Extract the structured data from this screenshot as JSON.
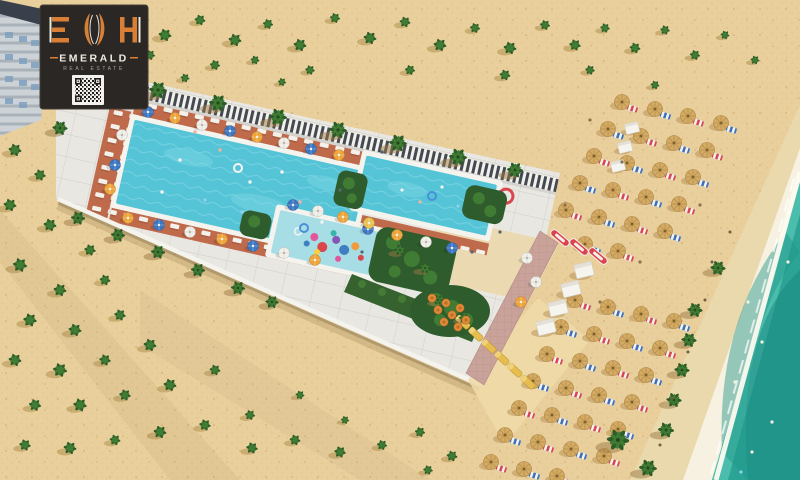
{
  "logo": {
    "monogram": "EMH",
    "monogram_left": "E",
    "monogram_right": "H",
    "brand": "EMERALD",
    "subtitle": "REAL ESTATE",
    "qr_icon": "qr-code",
    "colors": {
      "card": "#2b2724",
      "accent": "#d87f35",
      "text": "#f0ebe1",
      "subtext": "#aaa49a"
    }
  },
  "scene": {
    "type": "aerial-3d-render",
    "description": "Aerial 3D rendering of a beachfront resort strip with a large swimming pool, family pool, kids aqua-park pool with water slide, sun loungers and umbrellas, palm groves on sand, straw beach umbrellas, white cabanas, kayaks, and a turquoise sea shoreline",
    "features": [
      "apartment-building",
      "main-pool",
      "family-pool",
      "kids-pool",
      "water-slide",
      "perimeter-fence",
      "sun-deck",
      "restaurant-terrace",
      "garden-beds",
      "paved-path",
      "beach-umbrellas",
      "cabanas",
      "kayaks",
      "palm-trees",
      "sea-shoreline"
    ],
    "colors": {
      "sand": "#e9cf9c",
      "sand_speckle": "#d7b67e",
      "wet_sand": "#ead9ad",
      "foam": "#f6f1e0",
      "sea": "#2ba495",
      "sea_dark": "#17867d",
      "sea_light": "#52c3b2",
      "deck": "#e9e7e2",
      "pool_water": "#55c4d6",
      "kids_water": "#a7dde4",
      "mat": "#bf6a4b",
      "hedge": "#2f5c2c",
      "fence_dark": "#454a52",
      "umbrella_blue": "#3d77c2",
      "umbrella_orange": "#eda43b",
      "umbrella_white": "#f2f0ea",
      "straw": "#d4ab64",
      "kayak_red": "#db4350",
      "lounger_yellow": "#e6bd4e",
      "path_pink": "#c9a39a"
    },
    "sprite_names": {
      "buR": "beach-umbrella-with-lounger",
      "buB": "beach-umbrella-with-lounger",
      "cab": "beach-cabana",
      "kayak": "kayak",
      "ylg": "yellow-lounger",
      "palm": "palm-tree",
      "shrub": "desert-shrub",
      "umbB": "pool-umbrella",
      "umbO": "pool-umbrella",
      "umbW": "pool-umbrella",
      "umbY": "pool-umbrella",
      "tbl": "dining-table",
      "ringW": "swim-ring",
      "ringB": "swim-ring",
      "dot": "person"
    },
    "sprites": [
      [
        "buR",
        622,
        102
      ],
      [
        "buB",
        655,
        109
      ],
      [
        "buR",
        688,
        116
      ],
      [
        "buB",
        721,
        123
      ],
      [
        "buB",
        608,
        129
      ],
      [
        "buR",
        641,
        136
      ],
      [
        "buB",
        674,
        143
      ],
      [
        "buR",
        707,
        150
      ],
      [
        "buR",
        594,
        156
      ],
      [
        "buB",
        627,
        163
      ],
      [
        "buR",
        660,
        170
      ],
      [
        "buB",
        693,
        177
      ],
      [
        "buB",
        580,
        183
      ],
      [
        "buR",
        613,
        190
      ],
      [
        "buB",
        646,
        197
      ],
      [
        "buR",
        679,
        204
      ],
      [
        "buR",
        566,
        210
      ],
      [
        "buB",
        599,
        217
      ],
      [
        "buR",
        632,
        224
      ],
      [
        "buB",
        665,
        231
      ],
      [
        "buB",
        585,
        244
      ],
      [
        "buR",
        618,
        251
      ],
      [
        "buR",
        575,
        300
      ],
      [
        "buB",
        608,
        307
      ],
      [
        "buR",
        641,
        314
      ],
      [
        "buB",
        674,
        321
      ],
      [
        "buB",
        561,
        327
      ],
      [
        "buR",
        594,
        334
      ],
      [
        "buB",
        627,
        341
      ],
      [
        "buR",
        660,
        348
      ],
      [
        "buR",
        547,
        354
      ],
      [
        "buB",
        580,
        361
      ],
      [
        "buR",
        613,
        368
      ],
      [
        "buB",
        646,
        375
      ],
      [
        "buB",
        533,
        381
      ],
      [
        "buR",
        566,
        388
      ],
      [
        "buB",
        599,
        395
      ],
      [
        "buR",
        632,
        402
      ],
      [
        "buR",
        519,
        408
      ],
      [
        "buB",
        552,
        415
      ],
      [
        "buR",
        585,
        422
      ],
      [
        "buB",
        618,
        429
      ],
      [
        "buB",
        505,
        435
      ],
      [
        "buR",
        538,
        442
      ],
      [
        "buB",
        571,
        449
      ],
      [
        "buR",
        604,
        456
      ],
      [
        "buR",
        491,
        462
      ],
      [
        "buB",
        524,
        469
      ],
      [
        "buR",
        557,
        476
      ],
      [
        "cab",
        632,
        128,
        0,
        0.75
      ],
      [
        "cab",
        625,
        147,
        0,
        0.75
      ],
      [
        "cab",
        618,
        166,
        0,
        0.75
      ],
      [
        "cab",
        584,
        270
      ],
      [
        "cab",
        571,
        289
      ],
      [
        "cab",
        558,
        308
      ],
      [
        "cab",
        546,
        327
      ],
      [
        "kayak",
        560,
        238,
        40
      ],
      [
        "kayak",
        579,
        247,
        40
      ],
      [
        "kayak",
        598,
        256,
        40
      ],
      [
        "ylg",
        463,
        322,
        43
      ],
      [
        "ylg",
        476,
        334,
        43
      ],
      [
        "ylg",
        489,
        346,
        43
      ],
      [
        "ylg",
        502,
        358,
        43
      ],
      [
        "ylg",
        515,
        370,
        43
      ],
      [
        "ylg",
        528,
        382,
        43
      ],
      [
        "palm",
        98,
        76
      ],
      [
        "palm",
        158,
        90
      ],
      [
        "palm",
        218,
        103
      ],
      [
        "palm",
        278,
        117
      ],
      [
        "palm",
        338,
        130
      ],
      [
        "palm",
        398,
        143
      ],
      [
        "palm",
        458,
        157
      ],
      [
        "palm",
        515,
        170,
        0,
        0.9
      ],
      [
        "palm",
        60,
        128,
        0,
        0.85
      ],
      [
        "palm",
        78,
        218,
        0,
        0.8
      ],
      [
        "palm",
        118,
        235,
        0,
        0.8
      ],
      [
        "palm",
        158,
        252,
        0,
        0.8
      ],
      [
        "palm",
        198,
        270,
        0,
        0.8
      ],
      [
        "palm",
        238,
        288,
        0,
        0.8
      ],
      [
        "palm",
        272,
        302,
        0,
        0.75
      ],
      [
        "palm",
        695,
        310,
        0,
        0.85
      ],
      [
        "palm",
        689,
        340,
        0,
        0.85
      ],
      [
        "palm",
        682,
        370,
        0,
        0.85
      ],
      [
        "palm",
        674,
        400,
        0,
        0.85
      ],
      [
        "palm",
        666,
        430,
        0,
        0.9
      ],
      [
        "palm",
        618,
        440,
        0,
        1.25
      ],
      [
        "palm",
        648,
        468,
        0,
        1
      ],
      [
        "palm",
        718,
        268,
        0,
        0.85
      ],
      [
        "palm",
        400,
        250,
        0,
        0.65
      ],
      [
        "palm",
        425,
        268,
        0,
        0.65
      ],
      [
        "palm",
        438,
        300,
        0,
        0.6
      ],
      [
        "palm",
        464,
        318,
        0,
        0.6
      ],
      [
        "shrub",
        165,
        35
      ],
      [
        "shrub",
        200,
        20,
        0,
        0.85
      ],
      [
        "shrub",
        235,
        40
      ],
      [
        "shrub",
        268,
        24,
        0,
        0.8
      ],
      [
        "shrub",
        300,
        45
      ],
      [
        "shrub",
        335,
        18,
        0,
        0.8
      ],
      [
        "shrub",
        370,
        38
      ],
      [
        "shrub",
        405,
        22,
        0,
        0.85
      ],
      [
        "shrub",
        440,
        45
      ],
      [
        "shrub",
        475,
        28,
        0,
        0.8
      ],
      [
        "shrub",
        510,
        48
      ],
      [
        "shrub",
        545,
        25,
        0,
        0.8
      ],
      [
        "shrub",
        575,
        45,
        0,
        0.9
      ],
      [
        "shrub",
        605,
        28,
        0,
        0.75
      ],
      [
        "shrub",
        635,
        48,
        0,
        0.85
      ],
      [
        "shrub",
        665,
        30,
        0,
        0.75
      ],
      [
        "shrub",
        695,
        55,
        0,
        0.8
      ],
      [
        "shrub",
        725,
        35,
        0,
        0.7
      ],
      [
        "shrub",
        755,
        60,
        0,
        0.7
      ],
      [
        "shrub",
        215,
        65,
        0,
        0.8
      ],
      [
        "shrub",
        310,
        70,
        0,
        0.75
      ],
      [
        "shrub",
        410,
        70,
        0,
        0.8
      ],
      [
        "shrub",
        505,
        75,
        0,
        0.85
      ],
      [
        "shrub",
        590,
        70,
        0,
        0.75
      ],
      [
        "shrub",
        655,
        85,
        0,
        0.7
      ],
      [
        "shrub",
        150,
        55,
        0,
        0.8
      ],
      [
        "shrub",
        185,
        78,
        0,
        0.7
      ],
      [
        "shrub",
        255,
        60,
        0,
        0.7
      ],
      [
        "shrub",
        282,
        82,
        0,
        0.65
      ],
      [
        "shrub",
        15,
        150
      ],
      [
        "shrub",
        40,
        175,
        0,
        0.9
      ],
      [
        "shrub",
        10,
        205
      ],
      [
        "shrub",
        50,
        225
      ],
      [
        "shrub",
        90,
        250,
        0,
        0.9
      ],
      [
        "shrub",
        20,
        265,
        0,
        1.1
      ],
      [
        "shrub",
        60,
        290
      ],
      [
        "shrub",
        105,
        280,
        0,
        0.85
      ],
      [
        "shrub",
        30,
        320,
        0,
        1.05
      ],
      [
        "shrub",
        75,
        330
      ],
      [
        "shrub",
        120,
        315,
        0,
        0.9
      ],
      [
        "shrub",
        15,
        360
      ],
      [
        "shrub",
        60,
        370,
        0,
        1.1
      ],
      [
        "shrub",
        105,
        360,
        0,
        0.9
      ],
      [
        "shrub",
        150,
        345
      ],
      [
        "shrub",
        35,
        405,
        0,
        0.95
      ],
      [
        "shrub",
        80,
        405,
        0,
        1.05
      ],
      [
        "shrub",
        125,
        395,
        0,
        0.9
      ],
      [
        "shrub",
        170,
        385
      ],
      [
        "shrub",
        215,
        370,
        0,
        0.85
      ],
      [
        "shrub",
        25,
        445,
        0,
        0.9
      ],
      [
        "shrub",
        70,
        448
      ],
      [
        "shrub",
        115,
        440,
        0,
        0.85
      ],
      [
        "shrub",
        160,
        432
      ],
      [
        "shrub",
        205,
        425,
        0,
        0.9
      ],
      [
        "shrub",
        250,
        415,
        0,
        0.8
      ],
      [
        "shrub",
        252,
        448,
        0,
        0.9
      ],
      [
        "shrub",
        295,
        440,
        0,
        0.85
      ],
      [
        "shrub",
        340,
        452,
        0,
        0.9
      ],
      [
        "shrub",
        382,
        445,
        0,
        0.8
      ],
      [
        "shrub",
        300,
        395,
        0,
        0.7
      ],
      [
        "shrub",
        345,
        420,
        0,
        0.65
      ],
      [
        "shrub",
        420,
        432,
        0,
        0.8
      ],
      [
        "shrub",
        452,
        456,
        0,
        0.85
      ],
      [
        "shrub",
        428,
        470,
        0,
        0.75
      ],
      [
        "umbB",
        148,
        112
      ],
      [
        "umbO",
        175,
        118
      ],
      [
        "umbW",
        202,
        125
      ],
      [
        "umbB",
        230,
        131
      ],
      [
        "umbO",
        257,
        137
      ],
      [
        "umbW",
        284,
        143
      ],
      [
        "umbB",
        311,
        149
      ],
      [
        "umbO",
        339,
        155
      ],
      [
        "umbO",
        128,
        218
      ],
      [
        "umbB",
        159,
        225
      ],
      [
        "umbW",
        190,
        232
      ],
      [
        "umbO",
        222,
        239
      ],
      [
        "umbB",
        253,
        246
      ],
      [
        "umbW",
        284,
        253
      ],
      [
        "umbO",
        315,
        260
      ],
      [
        "umbW",
        122,
        135
      ],
      [
        "umbB",
        115,
        165
      ],
      [
        "umbO",
        110,
        189
      ],
      [
        "umbB",
        368,
        229
      ],
      [
        "umbO",
        397,
        235
      ],
      [
        "umbW",
        426,
        242
      ],
      [
        "umbB",
        452,
        248
      ],
      [
        "umbB",
        293,
        205
      ],
      [
        "umbW",
        318,
        211
      ],
      [
        "umbO",
        343,
        217
      ],
      [
        "umbY",
        369,
        223
      ],
      [
        "umbW",
        527,
        258
      ],
      [
        "umbW",
        536,
        282
      ],
      [
        "umbO",
        521,
        302
      ],
      [
        "tbl",
        432,
        298
      ],
      [
        "tbl",
        446,
        303
      ],
      [
        "tbl",
        460,
        308
      ],
      [
        "tbl",
        438,
        310
      ],
      [
        "tbl",
        452,
        315
      ],
      [
        "tbl",
        466,
        320
      ],
      [
        "tbl",
        444,
        322
      ],
      [
        "tbl",
        458,
        327
      ],
      [
        "ringW",
        238,
        168
      ],
      [
        "ringB",
        304,
        228
      ],
      [
        "ringB",
        432,
        196
      ],
      [
        "dot",
        180,
        160,
        1.7,
        "#f4f4f4"
      ],
      [
        "dot",
        220,
        150,
        1.7,
        "#f2b0a6"
      ],
      [
        "dot",
        250,
        182,
        1.7,
        "#f4f4f4"
      ],
      [
        "dot",
        205,
        200,
        1.7,
        "#8fd0ec"
      ],
      [
        "dot",
        282,
        172,
        1.7,
        "#f4f4f4"
      ],
      [
        "dot",
        300,
        202,
        1.7,
        "#f2b0a6"
      ],
      [
        "dot",
        162,
        192,
        1.7,
        "#f4f4f4"
      ],
      [
        "dot",
        242,
        212,
        1.7,
        "#8fd0ec"
      ],
      [
        "dot",
        322,
        222,
        1.7,
        "#f4f4f4"
      ],
      [
        "dot",
        195,
        132,
        1.7,
        "#f2b0a6"
      ],
      [
        "dot",
        402,
        190,
        1.6,
        "#f4f4f4"
      ],
      [
        "dot",
        420,
        202,
        1.6,
        "#f2b0a6"
      ],
      [
        "dot",
        442,
        187,
        1.6,
        "#f4f4f4"
      ],
      [
        "dot",
        458,
        206,
        1.6,
        "#8fd0ec"
      ],
      [
        "dot",
        362,
        252,
        1.6,
        "#5a6470"
      ],
      [
        "dot",
        472,
        252,
        1.6,
        "#5a6470"
      ],
      [
        "dot",
        500,
        232,
        1.6,
        "#5a6470"
      ],
      [
        "dot",
        382,
        152,
        1.6,
        "#5a6470"
      ],
      [
        "dot",
        340,
        190,
        1.6,
        "#5a6470"
      ],
      [
        "dot",
        600,
        302,
        1.6,
        "#8a7450"
      ],
      [
        "dot",
        640,
        262,
        1.6,
        "#8a7450"
      ],
      [
        "dot",
        565,
        205,
        1.6,
        "#8a7450"
      ],
      [
        "dot",
        622,
        162,
        1.6,
        "#8a7450"
      ],
      [
        "dot",
        700,
        205,
        1.6,
        "#8a7450"
      ],
      [
        "dot",
        590,
        120,
        1.6,
        "#8a7450"
      ],
      [
        "dot",
        705,
        300,
        1.5,
        "#6f5f43"
      ],
      [
        "dot",
        688,
        352,
        1.5,
        "#6f5f43"
      ],
      [
        "dot",
        672,
        398,
        1.5,
        "#6f5f43"
      ],
      [
        "dot",
        712,
        262,
        1.5,
        "#6f5f43"
      ],
      [
        "dot",
        660,
        445,
        1.5,
        "#6f5f43"
      ],
      [
        "dot",
        730,
        232,
        1.5,
        "#6f5f43"
      ],
      [
        "dot",
        748,
        302,
        1.6,
        "#f4f1e4"
      ],
      [
        "dot",
        762,
        342,
        1.6,
        "#f4f1e4"
      ],
      [
        "dot",
        735,
        382,
        1.6,
        "#f4f1e4"
      ],
      [
        "dot",
        772,
        422,
        1.6,
        "#f4f1e4"
      ],
      [
        "dot",
        752,
        452,
        1.6,
        "#f4f1e4"
      ],
      [
        "dot",
        788,
        262,
        1.6,
        "#f4f1e4"
      ],
      [
        "dot",
        741,
        472,
        1.6,
        "#8fd0ec"
      ]
    ]
  }
}
